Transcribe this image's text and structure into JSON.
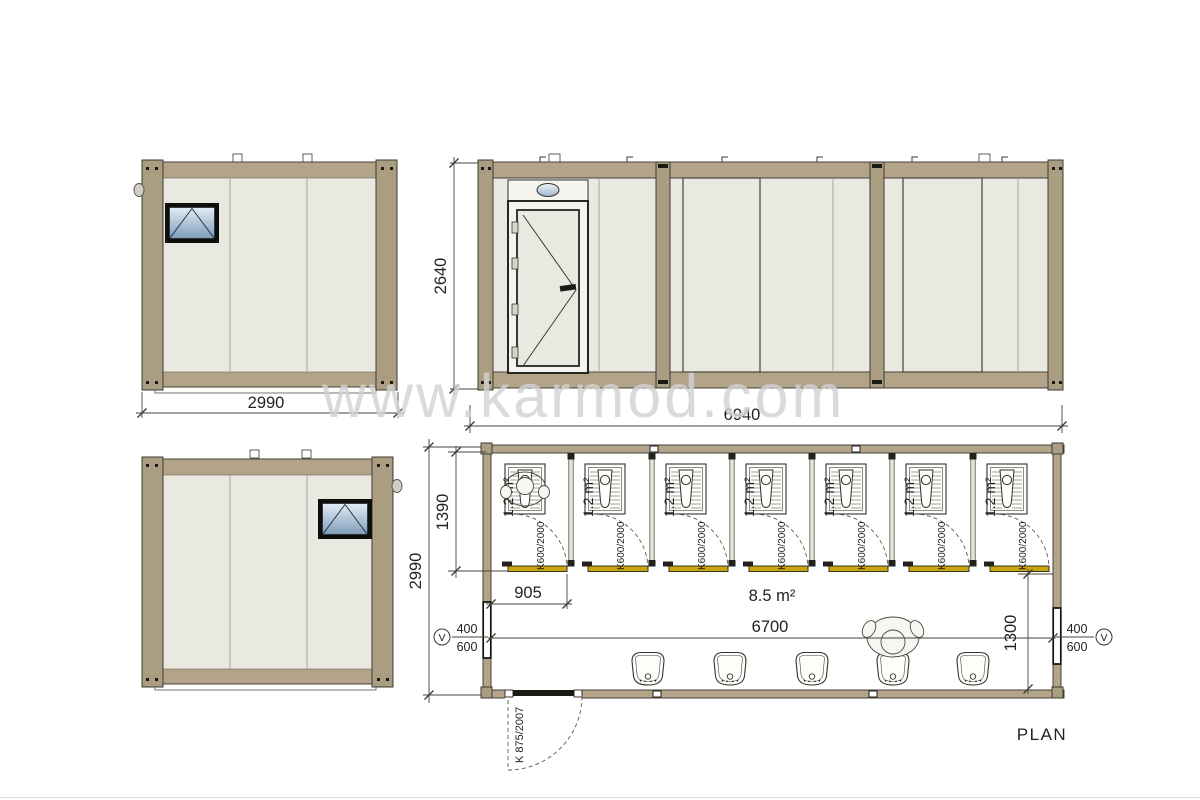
{
  "watermark": "www.karmod.com",
  "colors": {
    "frame_tan": "#b3a489",
    "panel_beige": "#eae9e1",
    "sill_yellow": "#c9a50e",
    "window_glass_top": "#e3edf6",
    "window_glass_bottom": "#7e9cba",
    "line_dark": "#3a3933",
    "watermark_gray": "#d2d2d2"
  },
  "elevations": {
    "side_a": {
      "width_dim": "2990"
    },
    "front": {
      "height_dim": "2640",
      "width_dim": "6940"
    }
  },
  "plan": {
    "title": "PLAN",
    "depth_dim": "2990",
    "stall_depth_dim": "1390",
    "first_stall_width_dim": "905",
    "hall": {
      "area": "8.5 m²",
      "width_dim": "6700",
      "depth_dim": "1300"
    },
    "entry_door_label": "K 875/2007",
    "window_left": {
      "symbol": "V",
      "width": "400",
      "height": "600"
    },
    "window_right": {
      "symbol": "V",
      "width": "400",
      "height": "600"
    },
    "stalls": [
      {
        "area": "1.2 m²",
        "door": "K600/2000"
      },
      {
        "area": "1.2 m²",
        "door": "K600/2000"
      },
      {
        "area": "1.2 m²",
        "door": "K600/2000"
      },
      {
        "area": "1.2 m²",
        "door": "K600/2000"
      },
      {
        "area": "1.2 m²",
        "door": "K600/2000"
      },
      {
        "area": "1.2 m²",
        "door": "K600/2000"
      },
      {
        "area": "1.2 m²",
        "door": "K600/2000"
      }
    ]
  }
}
